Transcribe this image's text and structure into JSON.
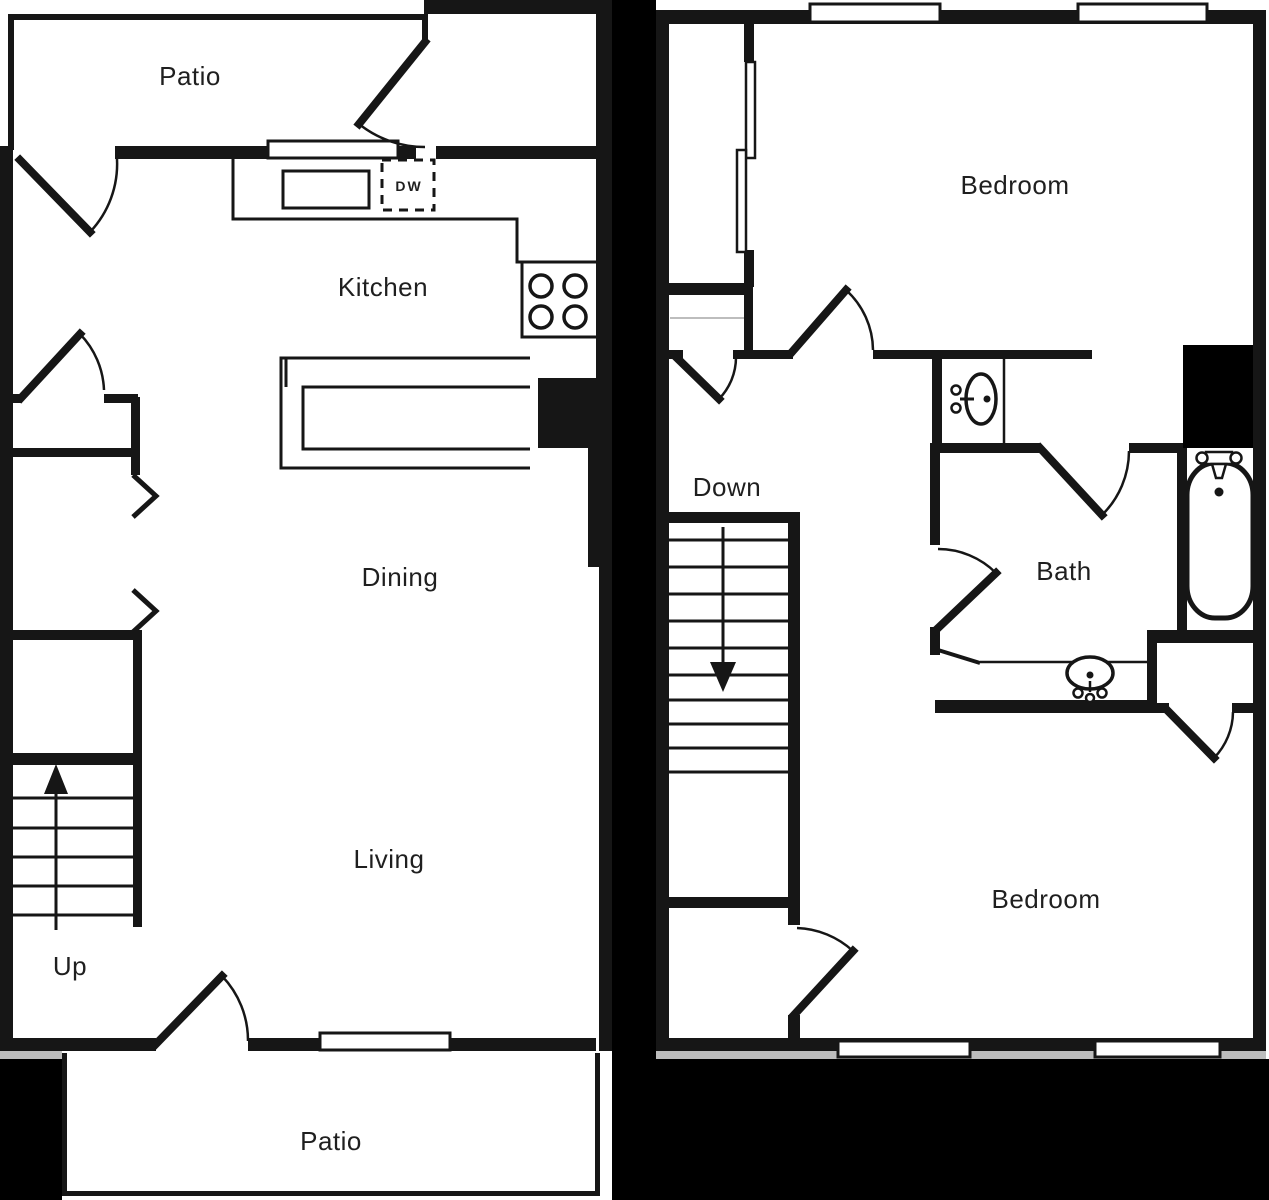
{
  "colors": {
    "wall": "#161616",
    "background": "#ffffff",
    "void_fill": "#000000",
    "label_text": "#1f1f1f",
    "shadow": "#bdbdbd"
  },
  "floor_1": {
    "rooms": {
      "patio_top": "Patio",
      "kitchen": "Kitchen",
      "dining": "Dining",
      "living": "Living",
      "patio_bottom": "Patio"
    },
    "stair_label": "Up",
    "appliances": {
      "dishwasher": "DW"
    },
    "icons": [
      "stove-burners-icon",
      "kitchen-sink-icon",
      "refrigerator-icon",
      "dishwasher-icon",
      "up-arrow-icon",
      "stair-treads-icon",
      "door-swing-icon",
      "window-icon",
      "opening-chevron-icon"
    ]
  },
  "floor_2": {
    "rooms": {
      "bedroom_top": "Bedroom",
      "bath": "Bath",
      "bedroom_bottom": "Bedroom"
    },
    "stair_label": "Down",
    "icons": [
      "bath-sink-icon",
      "vanity-sink-icon",
      "bathtub-icon",
      "down-arrow-icon",
      "stair-treads-icon",
      "door-swing-icon",
      "window-icon",
      "sliding-closet-door-icon"
    ]
  }
}
